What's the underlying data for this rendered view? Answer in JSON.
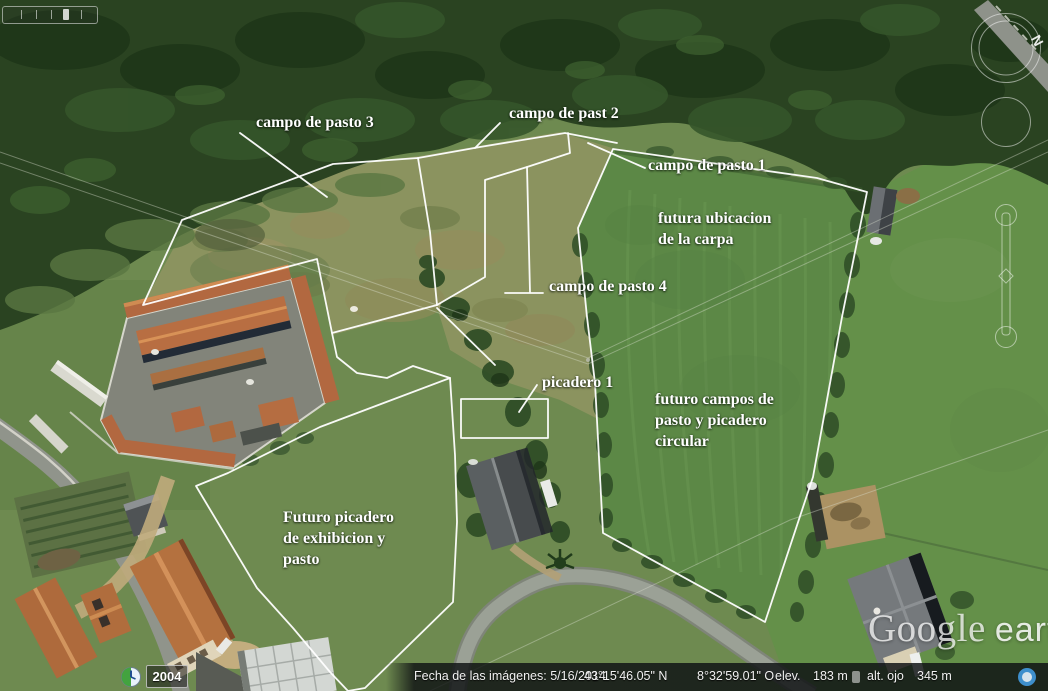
{
  "app": {
    "name": "Google Earth"
  },
  "watermark": {
    "brand": "Google",
    "product": "earth"
  },
  "status_bar": {
    "imagery_date": "Fecha de las imágenes: 5/16/2014",
    "latitude": "43°15'46.05\" N",
    "longitude": "8°32'59.01\" O",
    "elevation_label": "elev.",
    "elevation_value": "183 m",
    "eye_altitude_label": "alt. ojo",
    "eye_altitude_value": "345 m"
  },
  "timeline": {
    "year": "2004"
  },
  "navigation": {
    "north_label": "N"
  },
  "map_labels": [
    {
      "text": "campo de pasto 3",
      "x": 256,
      "y": 112
    },
    {
      "text": "campo de past 2",
      "x": 509,
      "y": 103
    },
    {
      "text": "campo de pasto 1",
      "x": 648,
      "y": 155
    },
    {
      "lines": [
        "futura ubicacion",
        "de la carpa"
      ],
      "x": 658,
      "y": 208
    },
    {
      "text": "campo de pasto 4",
      "x": 549,
      "y": 276
    },
    {
      "text": "picadero 1",
      "x": 542,
      "y": 372
    },
    {
      "lines": [
        "futuro campos de",
        "pasto y picadero",
        "circular"
      ],
      "x": 655,
      "y": 389
    },
    {
      "lines": [
        "Futuro picadero",
        "de exhibicion y",
        "pasto"
      ],
      "x": 283,
      "y": 507
    }
  ],
  "annotations": {
    "stroke": "#ffffff",
    "shapes": [
      {
        "name": "field-boundary-right",
        "closed": true,
        "points": [
          [
            613,
            149
          ],
          [
            817,
            178
          ],
          [
            867,
            192
          ],
          [
            842,
            317
          ],
          [
            813,
            477
          ],
          [
            765,
            622
          ],
          [
            603,
            533
          ],
          [
            595,
            383
          ],
          [
            587,
            317
          ],
          [
            578,
            228
          ]
        ]
      },
      {
        "name": "field-boundary-pasto-3",
        "closed": true,
        "points": [
          [
            418,
            158
          ],
          [
            333,
            164
          ],
          [
            182,
            220
          ],
          [
            143,
            305
          ],
          [
            317,
            259
          ],
          [
            332,
            333
          ],
          [
            437,
            305
          ],
          [
            430,
            232
          ]
        ]
      },
      {
        "name": "boundary-top",
        "closed": false,
        "points": [
          [
            418,
            158
          ],
          [
            480,
            147
          ],
          [
            565,
            133
          ],
          [
            617,
            143
          ]
        ]
      },
      {
        "name": "boundary-past-2-inner",
        "closed": false,
        "points": [
          [
            568,
            133
          ],
          [
            570,
            153
          ],
          [
            527,
            167
          ],
          [
            485,
            180
          ],
          [
            485,
            277
          ],
          [
            437,
            305
          ]
        ]
      },
      {
        "name": "divider-pasto-4",
        "closed": false,
        "points": [
          [
            527,
            167
          ],
          [
            530,
            292
          ]
        ]
      },
      {
        "name": "tick-pasto-4",
        "closed": false,
        "points": [
          [
            505,
            293
          ],
          [
            543,
            293
          ]
        ]
      },
      {
        "name": "boundary-connector",
        "closed": false,
        "points": [
          [
            332,
            333
          ],
          [
            337,
            357
          ],
          [
            357,
            373
          ],
          [
            387,
            378
          ],
          [
            413,
            366
          ],
          [
            450,
            378
          ]
        ]
      },
      {
        "name": "boundary-picadero-access",
        "closed": false,
        "points": [
          [
            437,
            308
          ],
          [
            495,
            365
          ]
        ]
      },
      {
        "name": "field-boundary-futuro-picadero",
        "closed": true,
        "points": [
          [
            450,
            378
          ],
          [
            455,
            455
          ],
          [
            457,
            522
          ],
          [
            453,
            602
          ],
          [
            365,
            688
          ],
          [
            348,
            691
          ],
          [
            330,
            672
          ],
          [
            293,
            628
          ],
          [
            257,
            588
          ],
          [
            196,
            486
          ],
          [
            228,
            473
          ],
          [
            320,
            427
          ]
        ]
      },
      {
        "name": "picadero-1-rect",
        "closed": true,
        "points": [
          [
            461,
            399
          ],
          [
            548,
            399
          ],
          [
            548,
            438
          ],
          [
            461,
            438
          ]
        ]
      },
      {
        "name": "leader-picadero-1",
        "closed": false,
        "points": [
          [
            537,
            385
          ],
          [
            519,
            412
          ]
        ]
      },
      {
        "name": "leader-past-2",
        "closed": false,
        "points": [
          [
            500,
            123
          ],
          [
            475,
            148
          ]
        ]
      },
      {
        "name": "leader-pasto-3",
        "closed": false,
        "points": [
          [
            240,
            133
          ],
          [
            327,
            197
          ]
        ]
      },
      {
        "name": "leader-pasto-1",
        "closed": false,
        "points": [
          [
            588,
            143
          ],
          [
            645,
            168
          ]
        ]
      }
    ]
  }
}
